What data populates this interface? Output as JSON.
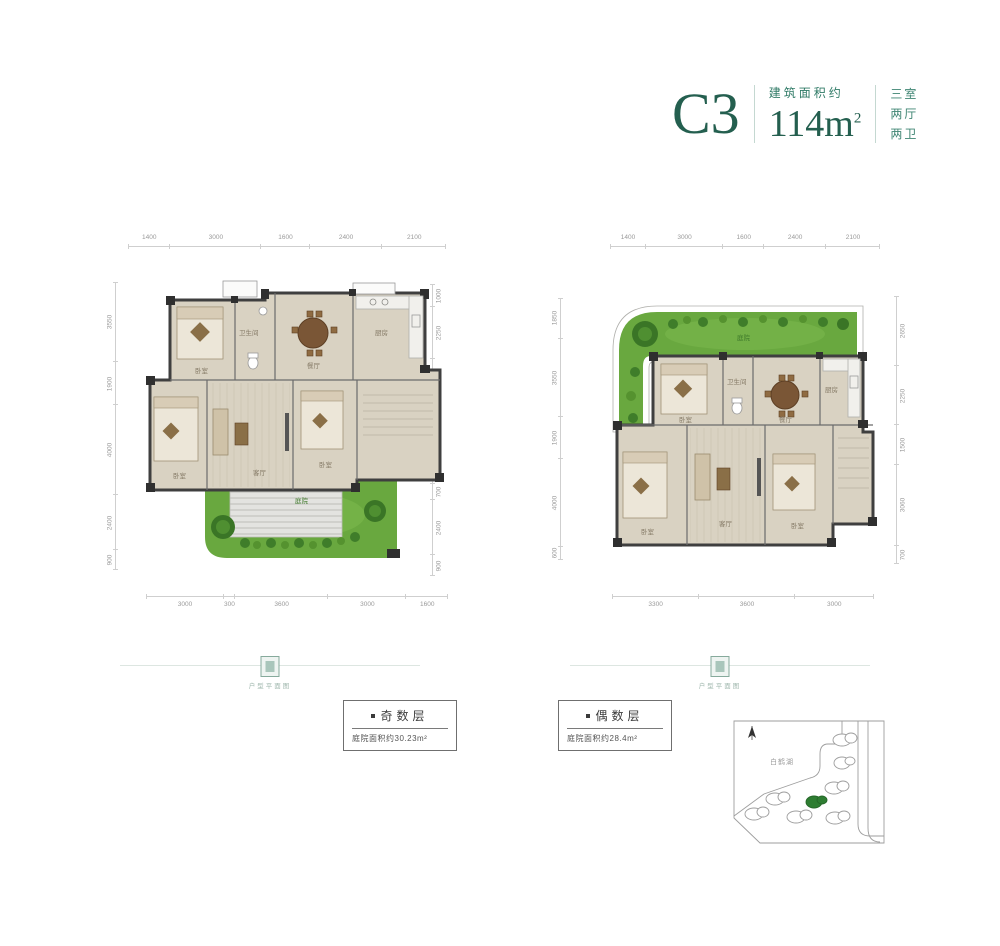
{
  "header": {
    "unit": "C3",
    "area_label": "建筑面积约",
    "area_value": "114m",
    "area_sup": "2",
    "layout_lines": [
      "三室",
      "两厅",
      "两卫"
    ]
  },
  "plans": {
    "odd": {
      "dims_top": [
        "1400",
        "3000",
        "1600",
        "2400",
        "2100"
      ],
      "dims_left": [
        "3550",
        "1900",
        "4000",
        "2400",
        "900"
      ],
      "dims_right": [
        "1000",
        "2250",
        "1500",
        "3900",
        "700",
        "2400",
        "900"
      ],
      "dims_bottom": [
        "3000",
        "300",
        "3600",
        "3000",
        "1600"
      ],
      "rooms": {
        "bedroom1": "卧室",
        "bath": "卫生间",
        "dining": "餐厅",
        "kitchen": "厨房",
        "bedroom2": "卧室",
        "living": "客厅",
        "bedroom3": "卧室",
        "courtyard": "庭院"
      },
      "badge": {
        "title": "奇数层",
        "subtitle": "庭院面积约30.23m²"
      }
    },
    "even": {
      "dims_top": [
        "1400",
        "3000",
        "1600",
        "2400",
        "2100"
      ],
      "dims_left": [
        "1850",
        "3550",
        "1900",
        "4000",
        "600"
      ],
      "dims_right": [
        "2650",
        "2250",
        "1500",
        "3060",
        "700"
      ],
      "dims_bottom": [
        "3300",
        "3600",
        "3000"
      ],
      "rooms": {
        "garden": "庭院",
        "bedroom1": "卧室",
        "bath": "卫生间",
        "dining": "餐厅",
        "kitchen": "厨房",
        "bedroom2": "卧室",
        "living": "客厅",
        "bedroom3": "卧室"
      },
      "badge": {
        "title": "偶数层",
        "subtitle": "庭院面积约28.4m²"
      }
    }
  },
  "divider_caption": "户型平面图",
  "sitemap": {
    "lake_label": "白鹤湖"
  },
  "colors": {
    "brand_teal": "#245f4f",
    "grass": "#69a83f",
    "wall": "#3d3d3d",
    "highlight_building": "#2e7d32"
  }
}
